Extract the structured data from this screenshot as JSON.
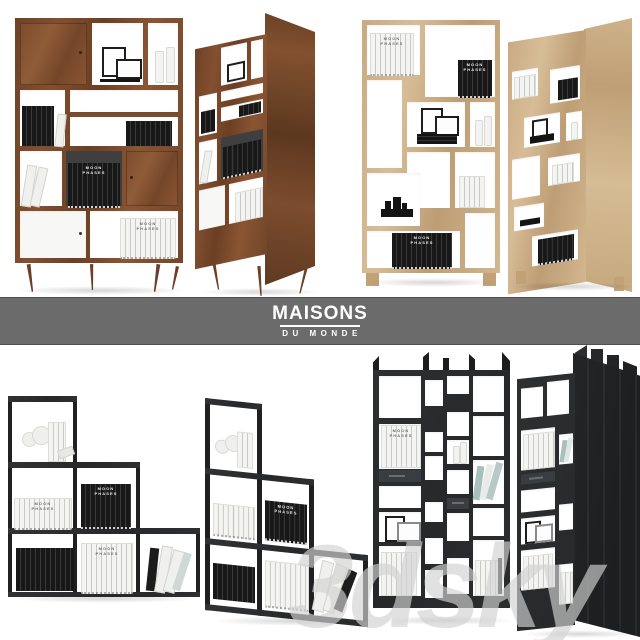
{
  "brand": {
    "primary": "MAISONS",
    "secondary": "DU MONDE"
  },
  "watermark": {
    "text": "3dsky"
  },
  "decor": {
    "book_set_label": "MOON\nPHASES"
  },
  "products": [
    {
      "id": "walnut-mid-century-bookcase",
      "material": "walnut wood with white doors",
      "views": [
        "front",
        "three-quarter"
      ]
    },
    {
      "id": "oak-open-shelf-unit",
      "material": "light oak",
      "views": [
        "front",
        "three-quarter"
      ]
    },
    {
      "id": "black-metal-stepped-shelf",
      "material": "black metal frame",
      "views": [
        "front",
        "three-quarter"
      ]
    },
    {
      "id": "black-asymmetric-bookcase",
      "material": "black wood with vertical fins",
      "views": [
        "front",
        "three-quarter"
      ]
    }
  ],
  "colors": {
    "background": "#ffffff",
    "band": "#6b6b6b",
    "logo_text": "#ffffff",
    "walnut": "#7b4a2d",
    "walnut_dark": "#5f3a22",
    "oak": "#cdb088",
    "oak_light": "#d8c09a",
    "metal_black": "#202020",
    "shelf_black": "#2b2d2e",
    "shelf_black_dark": "#1b1d1e",
    "book_black": "#1a1a1a",
    "book_white": "#f2f2f0",
    "book_teal": "#a9bfbc",
    "cell_white": "#ffffff",
    "watermark": "#d1d1d1",
    "backdrop_shadow": "rgba(0,0,0,0.16)"
  }
}
